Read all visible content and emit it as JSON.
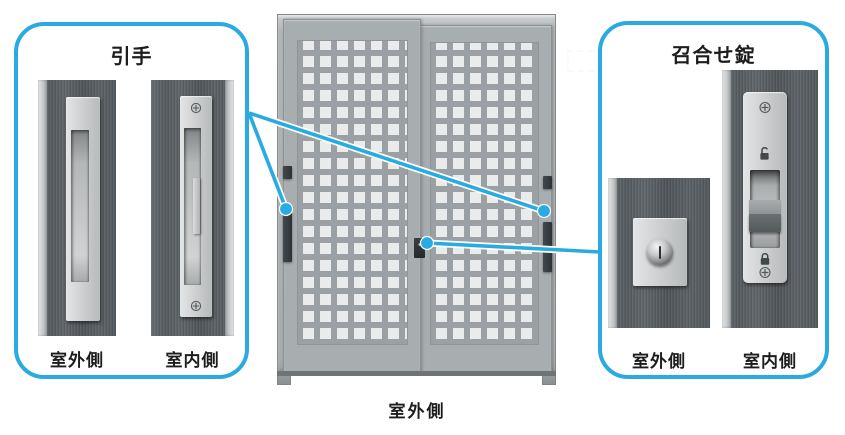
{
  "colors": {
    "accent": "#29abe2",
    "text": "#1d1d1d"
  },
  "handle_callout": {
    "title": "引手",
    "outdoor_label": "室外側",
    "indoor_label": "室内側"
  },
  "lock_callout": {
    "title": "召合せ錠",
    "outdoor_label": "室外側",
    "indoor_label": "室内側"
  },
  "door": {
    "bottom_label": "室外側"
  },
  "icons": {
    "screw": "plus-head-screw",
    "padlock_open": "unlocked-padlock",
    "padlock_closed": "locked-padlock",
    "cylinder": "key-cylinder"
  }
}
